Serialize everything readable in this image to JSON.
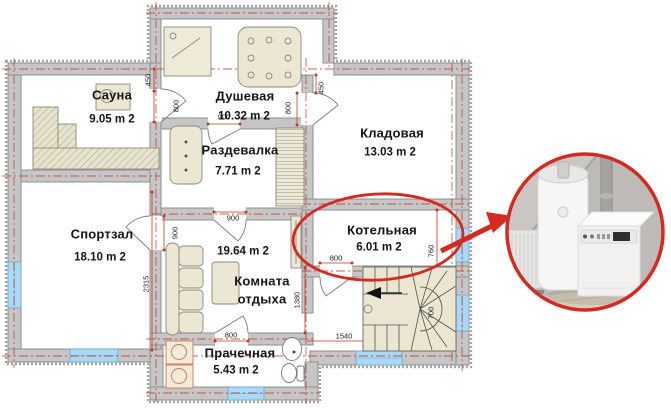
{
  "plan": {
    "rooms": [
      {
        "name": "Сауна",
        "area": "9.05 m 2"
      },
      {
        "name": "Душевая",
        "area": "10.32 m 2"
      },
      {
        "name": "Раздевалка",
        "area": "7.71 m 2"
      },
      {
        "name": "Кладовая",
        "area": "13.03 m 2"
      },
      {
        "name": "Спортзал",
        "area": "18.10 m 2"
      },
      {
        "name": "Комната отдыха",
        "name_line1": "Комната",
        "name_line2": "отдыха",
        "area": "19.64 m 2"
      },
      {
        "name": "Котельная",
        "area": "6.01 m 2"
      },
      {
        "name": "Прачечная",
        "area": "5.43 m 2"
      }
    ],
    "dimensions": [
      "450",
      "800",
      "900",
      "800",
      "450",
      "900",
      "900",
      "2315",
      "1380",
      "800",
      "760",
      "700",
      "800",
      "1540"
    ],
    "highlight": {
      "room": "Котельная",
      "color": "#d42a20"
    },
    "colors": {
      "wall": "#c6c6c6",
      "window": "#a9d9f5",
      "furniture": "#ece7d3",
      "stairs": "#ebe6d1",
      "axis_red": "#c0392b",
      "highlight_red": "#d42a20"
    }
  }
}
